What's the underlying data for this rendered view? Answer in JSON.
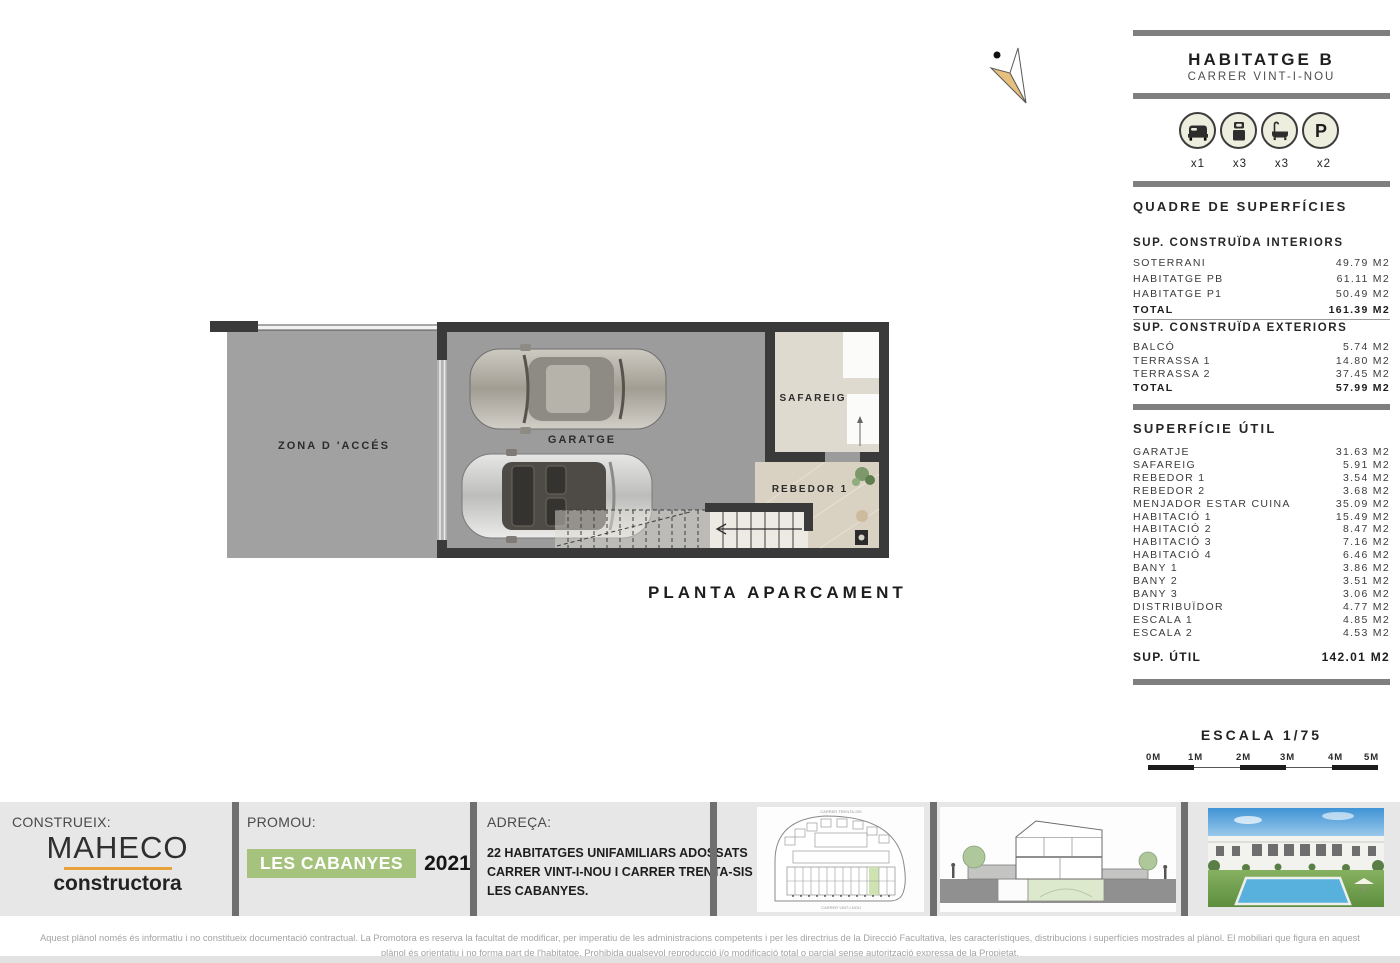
{
  "header": {
    "title": "HABITATGE B",
    "subtitle": "CARRER VINT-I-NOU"
  },
  "unit_icons": [
    {
      "icon": "double-bed-icon",
      "count": "x1"
    },
    {
      "icon": "single-bed-icon",
      "count": "x3"
    },
    {
      "icon": "bathtub-icon",
      "count": "x3"
    },
    {
      "icon": "parking-icon",
      "count": "x2",
      "letter": "P"
    }
  ],
  "surfaces": {
    "title": "QUADRE DE SUPERFÍCIES",
    "interiors": {
      "heading": "SUP. CONSTRUÏDA INTERIORS",
      "rows": [
        {
          "label": "SOTERRANI",
          "value": "49.79 M2"
        },
        {
          "label": "HABITATGE PB",
          "value": "61.11 M2"
        },
        {
          "label": "HABITATGE P1",
          "value": "50.49 M2"
        }
      ],
      "total_label": "TOTAL",
      "total_value": "161.39 M2"
    },
    "exteriors": {
      "heading": "SUP. CONSTRUÏDA EXTERIORS",
      "rows": [
        {
          "label": "BALCÓ",
          "value": "5.74 M2"
        },
        {
          "label": "TERRASSA 1",
          "value": "14.80 M2"
        },
        {
          "label": "TERRASSA 2",
          "value": "37.45 M2"
        }
      ],
      "total_label": "TOTAL",
      "total_value": "57.99 M2"
    },
    "util": {
      "heading": "SUPERFÍCIE ÚTIL",
      "rows": [
        {
          "label": "GARATJE",
          "value": "31.63 M2"
        },
        {
          "label": "SAFAREIG",
          "value": "5.91 M2"
        },
        {
          "label": "REBEDOR 1",
          "value": "3.54 M2"
        },
        {
          "label": "REBEDOR 2",
          "value": "3.68 M2"
        },
        {
          "label": "MENJADOR ESTAR CUINA",
          "value": "35.09 M2"
        },
        {
          "label": "HABITACIÓ 1",
          "value": "15.49 M2"
        },
        {
          "label": "HABITACIÓ 2",
          "value": "8.47 M2"
        },
        {
          "label": "HABITACIÓ 3",
          "value": "7.16 M2"
        },
        {
          "label": "HABITACIÓ 4",
          "value": "6.46 M2"
        },
        {
          "label": "BANY 1",
          "value": "3.86 M2"
        },
        {
          "label": "BANY 2",
          "value": "3.51 M2"
        },
        {
          "label": "BANY 3",
          "value": "3.06 M2"
        },
        {
          "label": "DISTRIBUÏDOR",
          "value": "4.77 M2"
        },
        {
          "label": "ESCALA 1",
          "value": "4.85 M2"
        },
        {
          "label": "ESCALA 2",
          "value": "4.53 M2"
        }
      ],
      "total_label": "SUP. ÚTIL",
      "total_value": "142.01 M2"
    }
  },
  "scale": {
    "label": "ESCALA 1/75",
    "ticks": [
      "0M",
      "1M",
      "2M",
      "3M",
      "4M",
      "5M"
    ]
  },
  "plan": {
    "zona_label": "ZONA D 'ACCÉS",
    "garatge_label": "GARATGE",
    "safareig_label": "SAFAREIG",
    "rebedor_label": "REBEDOR 1",
    "title": "PLANTA APARCAMENT"
  },
  "footer": {
    "constructor_label": "CONSTRUEIX:",
    "constructor_name": "MAHECO",
    "constructor_sub": "constructora",
    "promoter_label": "PROMOU:",
    "promoter_name": "LES CABANYES",
    "promoter_year": "2021",
    "address_label": "ADREÇA:",
    "address_line1": "22 HABITATGES UNIFAMILIARS ADOSSATS",
    "address_line2": "CARRER VINT-I-NOU I CARRER TRENTA-SIS",
    "address_line3": "LES CABANYES.",
    "site_plan_top_label": "CARRER TRENTA-SIS",
    "site_plan_bottom_label": "CARRER VINT-I-NOU"
  },
  "disclaimer": {
    "line1": "Aquest plànol només és informatiu i no constitueix documentació contractual. La Promotora es reserva la facultat de modificar, per imperatiu de les administracions competents i per les directrius de la Direcció Facultativa, les característiques, distribucions i superfícies mostrades al plànol. El mobiliari que figura en aquest",
    "line2": "plànol és orientatiu i no forma part de l'habitatge. Prohibida qualsevol reproducció i/o modificació total o parcial sense autorització expressa de la Propietat."
  },
  "colors": {
    "accent_green": "#a6c37e",
    "accent_orange": "#e9a23b",
    "wall": "#3a3a3a",
    "floor_gray": "#9c9c9c",
    "bar_gray": "#7f7f7f"
  }
}
